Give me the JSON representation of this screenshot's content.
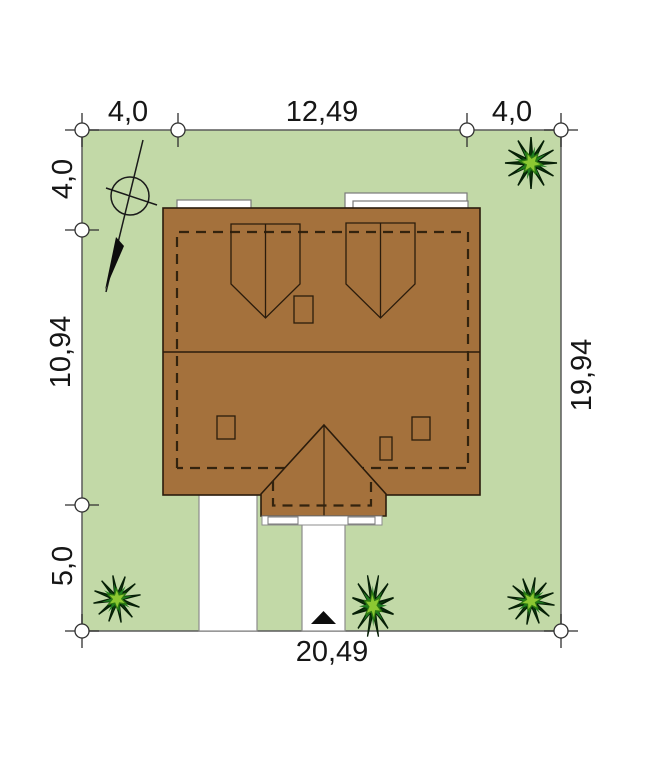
{
  "plan": {
    "title": "house-site-plan",
    "dimensions": {
      "top_left": "4,0",
      "top_center": "12,49",
      "top_right": "4,0",
      "left_top": "4,0",
      "left_center": "10,94",
      "left_bottom": "5,0",
      "right_side": "19,94",
      "bottom": "20,49"
    },
    "icons": {
      "north_arrow": "north-arrow-compass",
      "bush": "bush-icon",
      "entrance": "entrance-arrow-icon",
      "survey_marker": "survey-marker-icon"
    },
    "colors": {
      "grass": "#c2d9a7",
      "roof": "#a4713c",
      "dash": "#33230e",
      "outline": "#2b1c0c",
      "plot_line": "#5a5a5a",
      "path_white": "#ffffff",
      "foliage_dark": "#1e7c1e",
      "foliage_mid": "#2f961c",
      "foliage_light": "#8cc832",
      "ink": "#161616"
    }
  }
}
